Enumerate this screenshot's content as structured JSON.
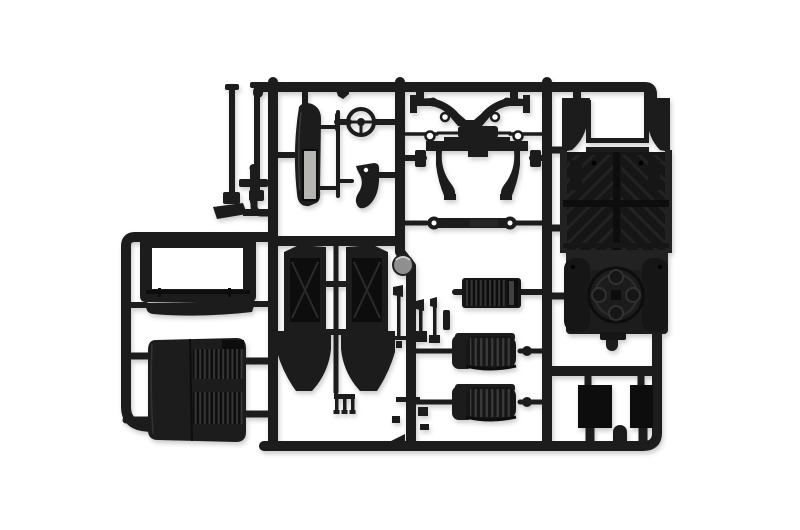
{
  "image": {
    "type": "product-photograph",
    "subject": "black injection-molded plastic model kit sprue (parts tree) on white background"
  },
  "colors": {
    "background": "#ffffff",
    "plastic": "#1c1c1c",
    "plastic_dark": "#0d0d0d",
    "plastic_mid": "#262626",
    "inset_gray": "#b7b5b0",
    "disc_gray": "#8f8f8f"
  },
  "parts": {
    "frame": "sprue runner frame",
    "rods": "two exhaust stack rods",
    "valve": "small cross-shaped fitting",
    "pedal_plate": "flat step plate",
    "side_blade": "curved side panel with gray inset",
    "steering_wheel": "steering wheel with spokes",
    "bracket": "curved seat bracket",
    "suspension_arms": "V-shaped upper suspension arm pair",
    "tie_rod": "tie rod with center block and ring ends",
    "front_axle": "front axle beam with kingpin legs",
    "drag_link": "drag link rod with eye ends",
    "windshield_frame": "rectangular windshield frame",
    "cowl_panel": "flat cowl blade panel",
    "radiator_grille": "folded louvered radiator / hood panel",
    "seat_back_panels": "mirrored seat-back / door panels with flared skirts",
    "fork": "three-prong fork fitting",
    "levers": "gear and brake lever cluster",
    "pedal_board": "ribbed pedal board panel",
    "gray_disc": "round gray hub disc",
    "seats": "two ribbed bench seats with side knobs",
    "floor_pan": "chassis floor pan with tread pattern and footwell opening",
    "engine_block": "engine / transmission block with circular clutch housing",
    "flat_panels": "two small rectangular flat panels",
    "small_cluster": "small linkage cluster near lower runner"
  }
}
